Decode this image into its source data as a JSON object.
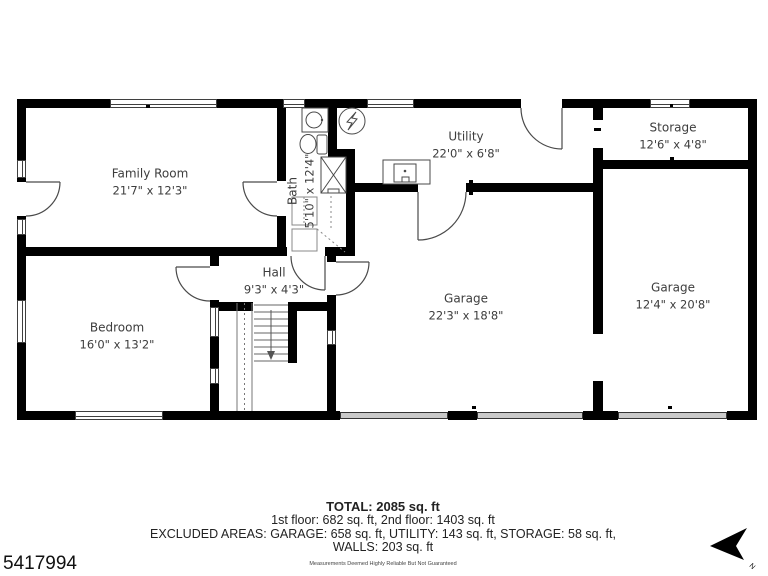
{
  "floor_plan": {
    "rooms": [
      {
        "name": "Family Room",
        "dims": "21'7\" x 12'3\""
      },
      {
        "name": "Bedroom",
        "dims": "16'0\" x 13'2\""
      },
      {
        "name": "Hall",
        "dims": "9'3\" x 4'3\""
      },
      {
        "name": "Bath",
        "dims": "5'10\" x 12'4\""
      },
      {
        "name": "Utility",
        "dims": "22'0\" x 6'8\""
      },
      {
        "name": "Storage",
        "dims": "12'6\" x 4'8\""
      },
      {
        "name": "Garage",
        "dims": "22'3\" x 18'8\""
      },
      {
        "name": "Garage",
        "dims": "12'4\" x 20'8\""
      }
    ],
    "compass_label": "N"
  },
  "summary": {
    "total": "TOTAL: 2085 sq. ft",
    "floors": "1st floor: 682 sq. ft, 2nd floor: 1403 sq. ft",
    "excluded": "EXCLUDED AREAS: GARAGE: 658 sq. ft, UTILITY: 143 sq. ft, STORAGE: 58 sq. ft,",
    "walls": "WALLS: 203 sq. ft",
    "disclaimer": "Measurements Deemed Highly Reliable But Not Guaranteed"
  },
  "listing_number": "5417994",
  "colors": {
    "wall": "#000000",
    "line": "#4a4a4a",
    "garage_door_fill": "#c9c9c9",
    "label_text": "#3d3d3d"
  }
}
